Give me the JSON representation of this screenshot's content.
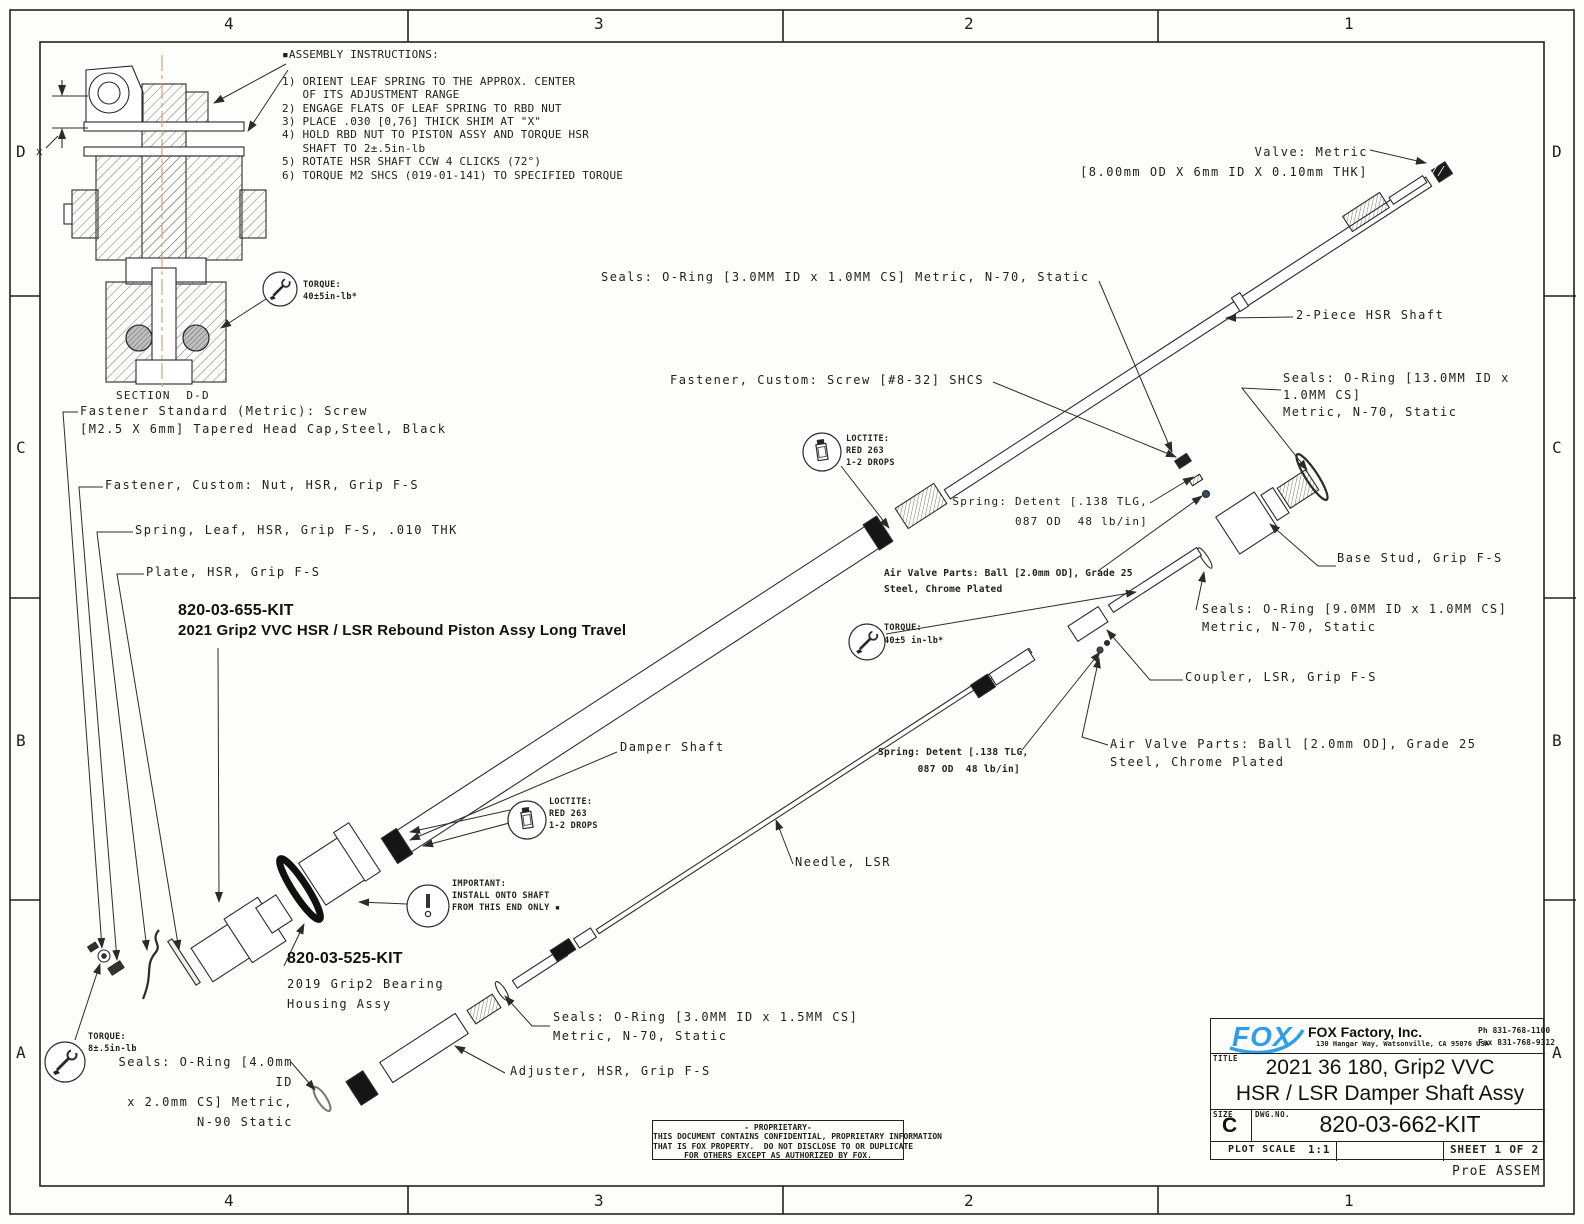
{
  "sheet": {
    "zone_cols": [
      "4",
      "3",
      "2",
      "1"
    ],
    "zone_rows": [
      "D",
      "C",
      "B",
      "A"
    ],
    "footer_note": "ProE ASSEM"
  },
  "colors": {
    "line": "#2b2b2b",
    "centerline": "#cfa670",
    "logo_blue": "#2e9fe6",
    "paper": "#fdfdfc"
  },
  "callouts": [
    {
      "id": "assembly-instructions",
      "text": "▪ASSEMBLY INSTRUCTIONS:\n\n1) ORIENT LEAF SPRING TO THE APPROX. CENTER\n   OF ITS ADJUSTMENT RANGE\n2) ENGAGE FLATS OF LEAF SPRING TO RBD NUT\n3) PLACE .030 [0,76] THICK SHIM AT \"X\"\n4) HOLD RBD NUT TO PISTON ASSY AND TORQUE HSR\n   SHAFT TO 2±.5in-lb\n5) ROTATE HSR SHAFT CCW 4 CLICKS (72°)\n6) TORQUE M2 SHCS (019-01-141) TO SPECIFIED TORQUE"
    },
    {
      "id": "valve-metric",
      "text": "Valve: Metric\n[8.00mm OD X 6mm ID X 0.10mm THK]"
    },
    {
      "id": "seals-oring-3x1",
      "text": "Seals: O-Ring [3.0MM ID x 1.0MM CS] Metric, N-70, Static"
    },
    {
      "id": "two-piece-hsr-shaft",
      "text": "2-Piece HSR Shaft"
    },
    {
      "id": "fastener-screw-8-32",
      "text": "Fastener, Custom: Screw [#8-32] SHCS"
    },
    {
      "id": "seals-oring-13x1",
      "text": "Seals: O-Ring [13.0MM ID x\n1.0MM CS]\nMetric, N-70, Static"
    },
    {
      "id": "loctite-note-1",
      "text": "LOCTITE:\nRED 263\n1-2 DROPS"
    },
    {
      "id": "spring-detent-1",
      "text": "Spring: Detent [.138 TLG,\n087 OD  48 lb/in]"
    },
    {
      "id": "air-valve-parts-1",
      "text": "Air Valve Parts: Ball [2.0mm OD], Grade 25\nSteel, Chrome Plated"
    },
    {
      "id": "base-stud",
      "text": "Base Stud, Grip F-S"
    },
    {
      "id": "seals-oring-9x1",
      "text": "Seals: O-Ring [9.0MM ID x 1.0MM CS]\nMetric, N-70, Static"
    },
    {
      "id": "coupler-lsr",
      "text": "Coupler, LSR, Grip F-S"
    },
    {
      "id": "torque-40-top",
      "text": "TORQUE:\n40±5in-lb*"
    },
    {
      "id": "torque-40-mid",
      "text": "TORQUE:\n40±5 in-lb*"
    },
    {
      "id": "spring-detent-2",
      "text": "Spring: Detent [.138 TLG,\n087 OD  48 lb/in]"
    },
    {
      "id": "air-valve-parts-2",
      "text": "Air Valve Parts: Ball [2.0mm OD], Grade 25\nSteel, Chrome Plated"
    },
    {
      "id": "damper-shaft",
      "text": "Damper Shaft"
    },
    {
      "id": "loctite-note-2",
      "text": "LOCTITE:\nRED 263\n1-2 DROPS"
    },
    {
      "id": "needle-lsr",
      "text": "Needle, LSR"
    },
    {
      "id": "important-note",
      "text": "IMPORTANT:\nINSTALL ONTO SHAFT\nFROM THIS END ONLY ▪"
    },
    {
      "id": "kit-655-number",
      "text": "820-03-655-KIT"
    },
    {
      "id": "kit-655-desc",
      "text": "2021 Grip2 VVC HSR / LSR Rebound Piston Assy Long Travel"
    },
    {
      "id": "kit-525-number",
      "text": "820-03-525-KIT"
    },
    {
      "id": "kit-525-desc",
      "text": "2019 Grip2 Bearing\nHousing Assy"
    },
    {
      "id": "fastener-standard",
      "text": "Fastener Standard (Metric): Screw\n[M2.5 X 6mm] Tapered Head Cap,Steel, Black"
    },
    {
      "id": "fastener-nut",
      "text": "Fastener, Custom: Nut, HSR, Grip F-S"
    },
    {
      "id": "spring-leaf",
      "text": "Spring, Leaf, HSR, Grip F-S, .010 THK"
    },
    {
      "id": "plate-hsr",
      "text": "Plate, HSR, Grip F-S"
    },
    {
      "id": "torque-8",
      "text": "TORQUE:\n8±.5in-lb"
    },
    {
      "id": "seals-oring-4x2",
      "text": "Seals: O-Ring [4.0mm\nID\nx 2.0mm CS] Metric,\nN-90 Static"
    },
    {
      "id": "seals-oring-3x15",
      "text": "Seals: O-Ring [3.0MM ID x 1.5MM CS]\nMetric, N-70, Static"
    },
    {
      "id": "adjuster-hsr",
      "text": "Adjuster, HSR, Grip F-S"
    },
    {
      "id": "section-label",
      "text": "SECTION  D-D"
    },
    {
      "id": "dim-x",
      "text": "x"
    }
  ],
  "title_block": {
    "logo_text": "FOX",
    "company": "FOX Factory, Inc.",
    "address": "130 Hangar Way, Watsonville, CA 95076 USA",
    "phone": "Ph 831-768-1100",
    "fax": "Fax 831-768-9312",
    "title_label": "TITLE",
    "title_line1": "2021 36 180, Grip2 VVC",
    "title_line2": "HSR / LSR Damper Shaft Assy",
    "size_label": "SIZE",
    "size_value": "C",
    "dwg_label": "DWG.NO.",
    "dwg_value": "820-03-662-KIT",
    "plot_scale_label": "PLOT SCALE",
    "plot_scale_value": "1:1",
    "sheet_label": "SHEET 1 OF 2"
  },
  "proprietary": {
    "text": "- PROPRIETARY-\nTHIS DOCUMENT CONTAINS CONFIDENTIAL, PROPRIETARY INFORMATION\nTHAT IS FOX PROPERTY.  DO NOT DISCLOSE TO OR DUPLICATE\nFOR OTHERS EXCEPT AS AUTHORIZED BY FOX."
  }
}
